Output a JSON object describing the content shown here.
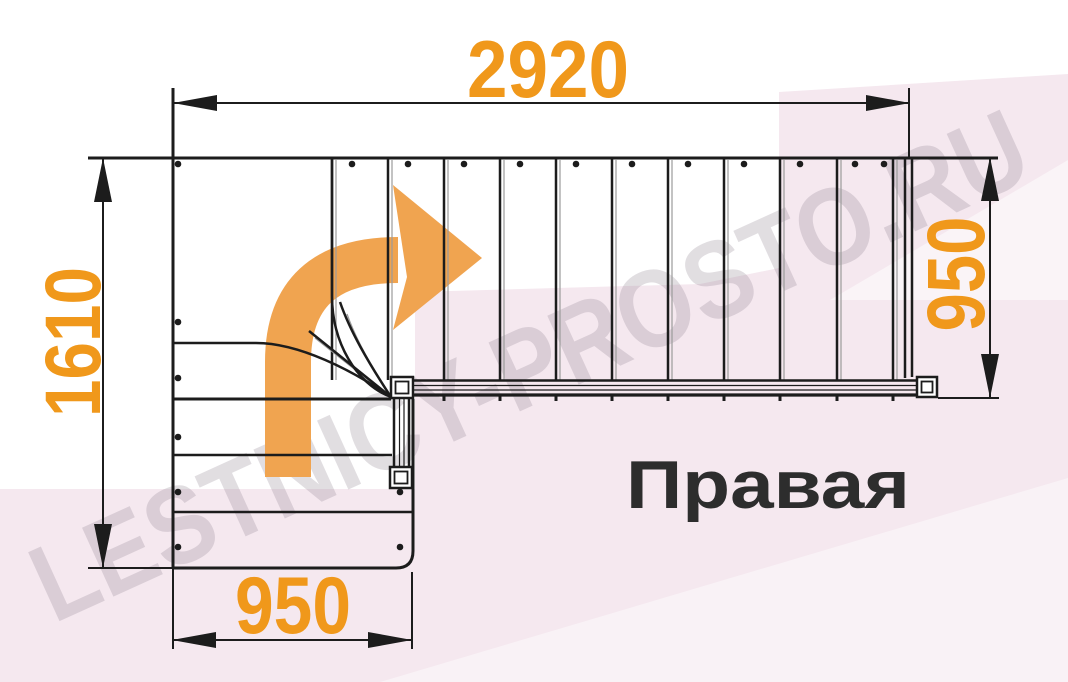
{
  "diagram": {
    "type_label": "Правая",
    "watermark": "LESTNICY-PROSTO.RU",
    "dimensions": {
      "top_width": "2920",
      "left_height": "1610",
      "right_flight_width": "950",
      "bottom_flight_width": "950"
    },
    "colors": {
      "dimension_text": "#F0981B",
      "direction_arrow": "#F0A450",
      "drawing_line": "#1C1C1C",
      "label_text": "#2D2D2D",
      "background_pink": "#F5E8EF"
    }
  }
}
